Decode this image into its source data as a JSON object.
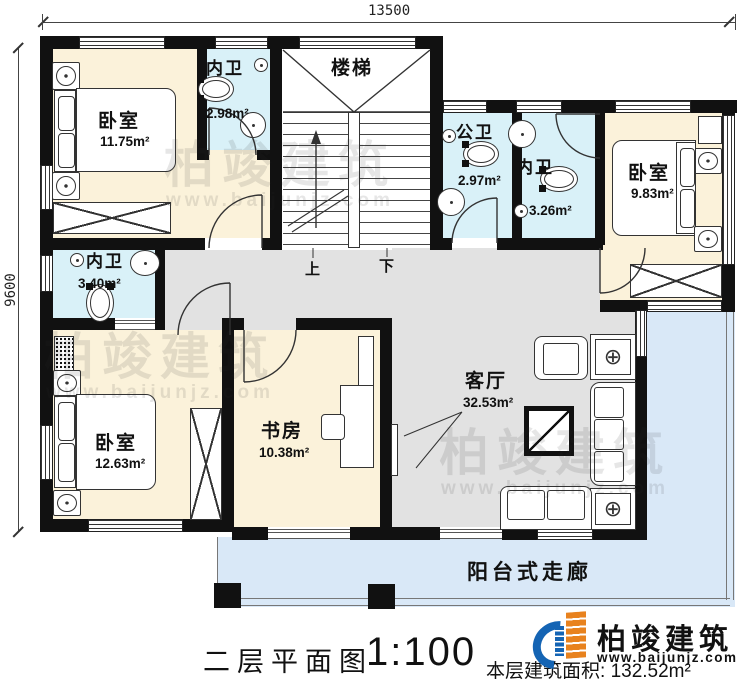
{
  "dimensions": {
    "width": "13500",
    "height": "9600"
  },
  "rooms": {
    "bedroom_tl": {
      "label": "卧室",
      "area": "11.75m²"
    },
    "bath_tl": {
      "label": "内卫",
      "area": "2.98m²"
    },
    "stairs": {
      "label": "楼梯",
      "up": "上",
      "down": "下"
    },
    "bath_public": {
      "label": "公卫",
      "area": "2.97m²"
    },
    "bath_tr": {
      "label": "内卫",
      "area": "3.26m²"
    },
    "bedroom_tr": {
      "label": "卧室",
      "area": "9.83m²"
    },
    "bath_ml": {
      "label": "内卫",
      "area": "3.40m²"
    },
    "bedroom_bl": {
      "label": "卧室",
      "area": "12.63m²"
    },
    "study": {
      "label": "书房",
      "area": "10.38m²"
    },
    "living": {
      "label": "客厅",
      "area": "32.53m²"
    },
    "balcony": {
      "label": "阳台式走廊"
    }
  },
  "footer": {
    "plan_title": "二层平面图",
    "scale": "1:100",
    "area_label": "本层建筑面积:",
    "area_value": "132.52m²"
  },
  "brand": {
    "name": "柏竣建筑",
    "website": "www.baijunjz.com"
  },
  "colors": {
    "room_cream": "#FBF2DA",
    "bath_blue": "#D9F1F8",
    "hall_gray": "#E2E2E2",
    "balcony_blue": "#D9E8F7",
    "wall": "#111111",
    "logo_blue": "#1464B4",
    "logo_orange": "#E8821E"
  }
}
